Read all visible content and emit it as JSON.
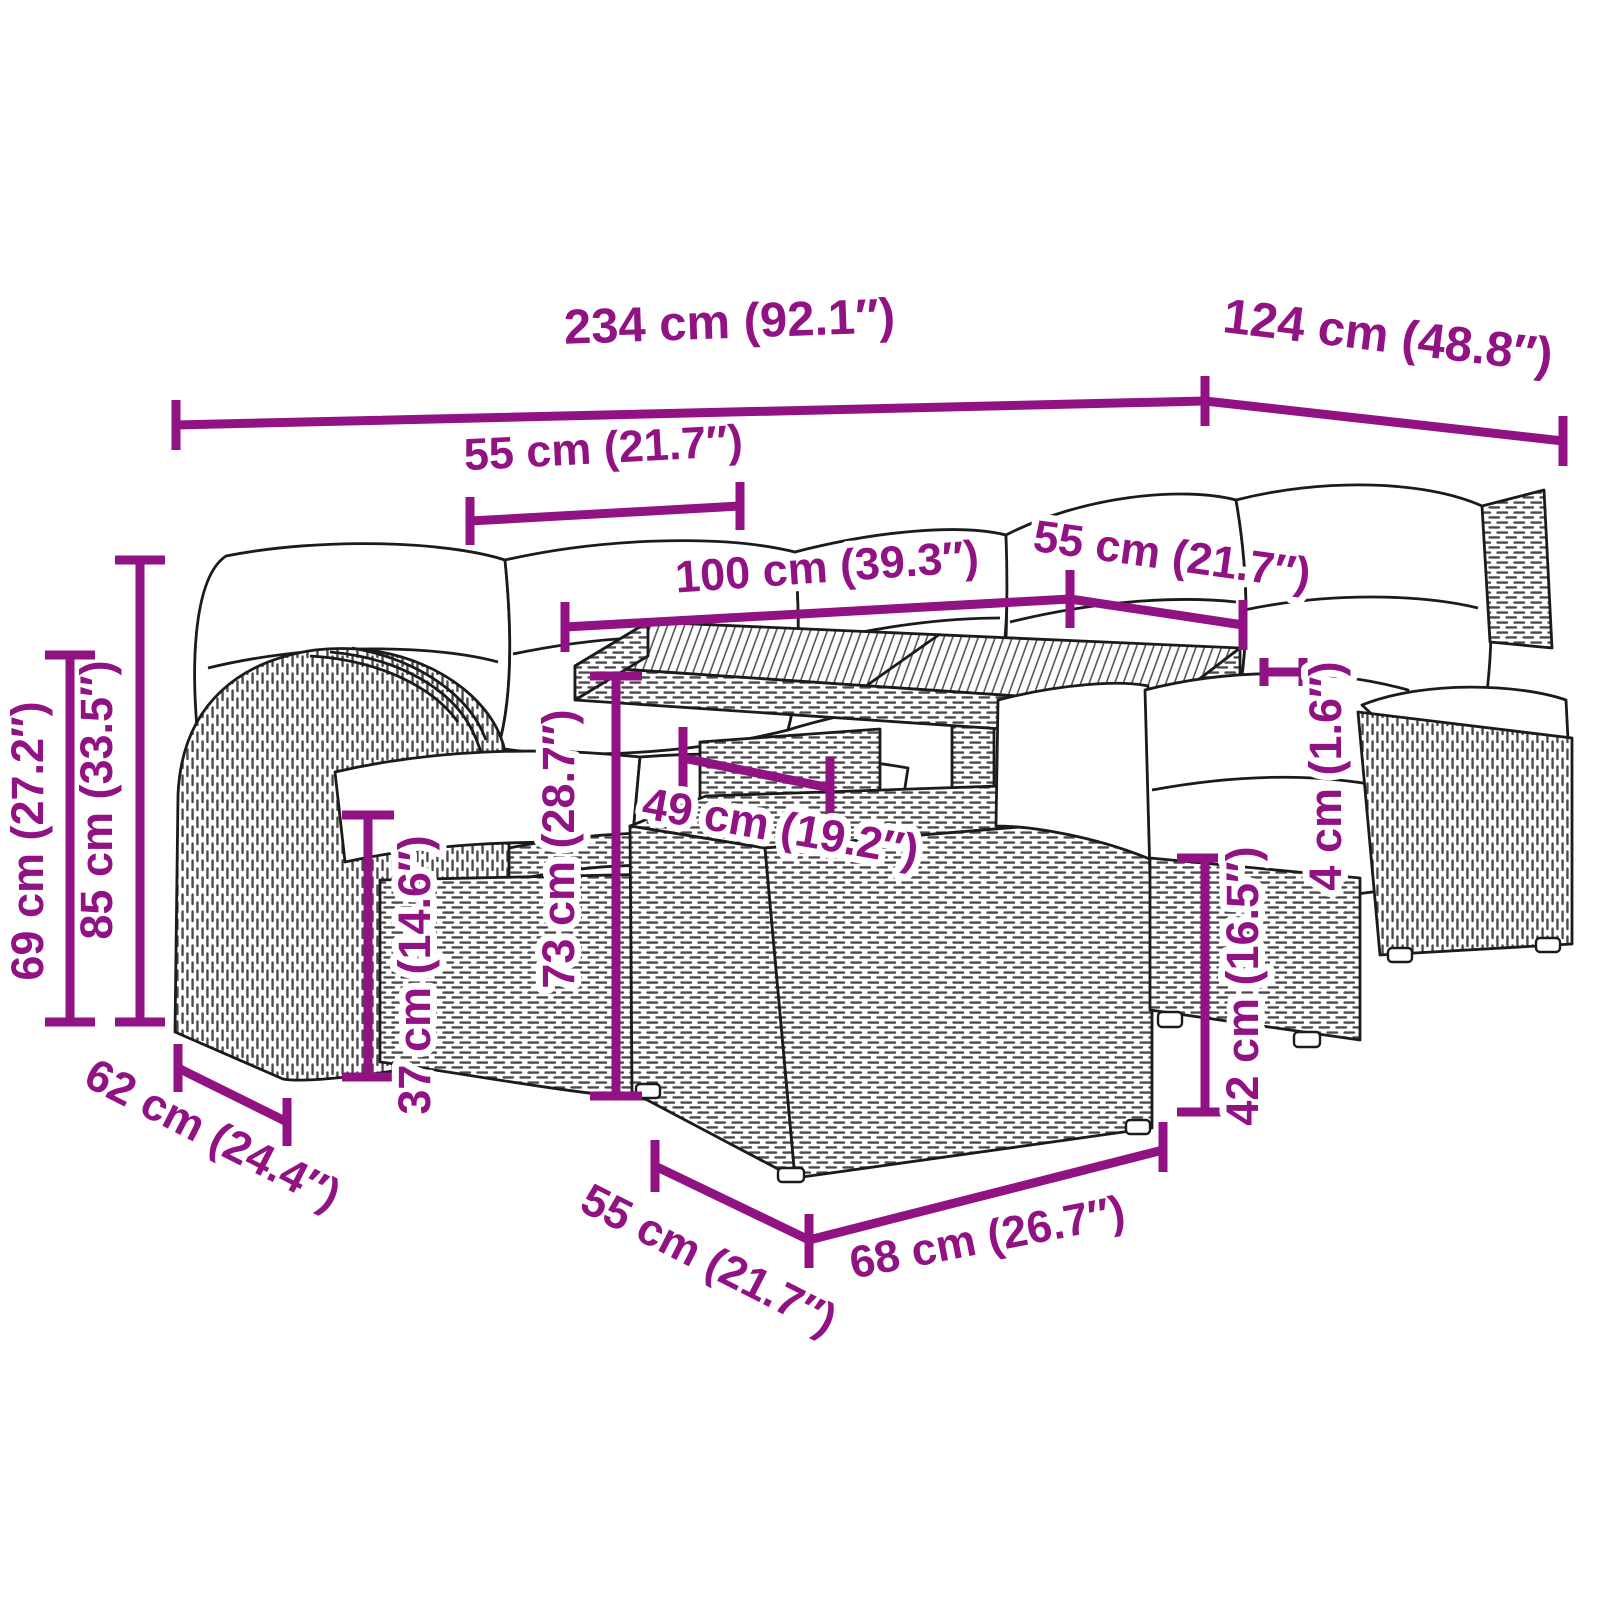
{
  "diagram": {
    "kind": "product-dimension-diagram",
    "subject": "poly-rattan garden lounge set with cushions, wood-top table and footstool",
    "accent_color": "#911283",
    "linework_color": "#1b1b1b",
    "dimensions": [
      {
        "id": "total-width",
        "label": "234 cm (92.1″)"
      },
      {
        "id": "right-wing-depth",
        "label": "124 cm (48.8″)"
      },
      {
        "id": "seat-width-left",
        "label": "55 cm (21.7″)"
      },
      {
        "id": "table-length",
        "label": "100 cm (39.3″)"
      },
      {
        "id": "seat-width-right",
        "label": "55 cm (21.7″)"
      },
      {
        "id": "backrest-height",
        "label": "85 cm (33.5″)"
      },
      {
        "id": "armrest-height",
        "label": "69 cm (27.2″)"
      },
      {
        "id": "table-height",
        "label": "73 cm (28.7″)"
      },
      {
        "id": "seat-height",
        "label": "37 cm (14.6″)"
      },
      {
        "id": "table-base-width",
        "label": "49 cm (19.2″)"
      },
      {
        "id": "cushion-thickness",
        "label": "4 cm (1.6″)"
      },
      {
        "id": "footstool-height",
        "label": "42 cm (16.5″)"
      },
      {
        "id": "seat-depth",
        "label": "62 cm (24.4″)"
      },
      {
        "id": "footstool-depth",
        "label": "55 cm (21.7″)"
      },
      {
        "id": "footstool-width",
        "label": "68 cm (26.7″)"
      }
    ]
  }
}
